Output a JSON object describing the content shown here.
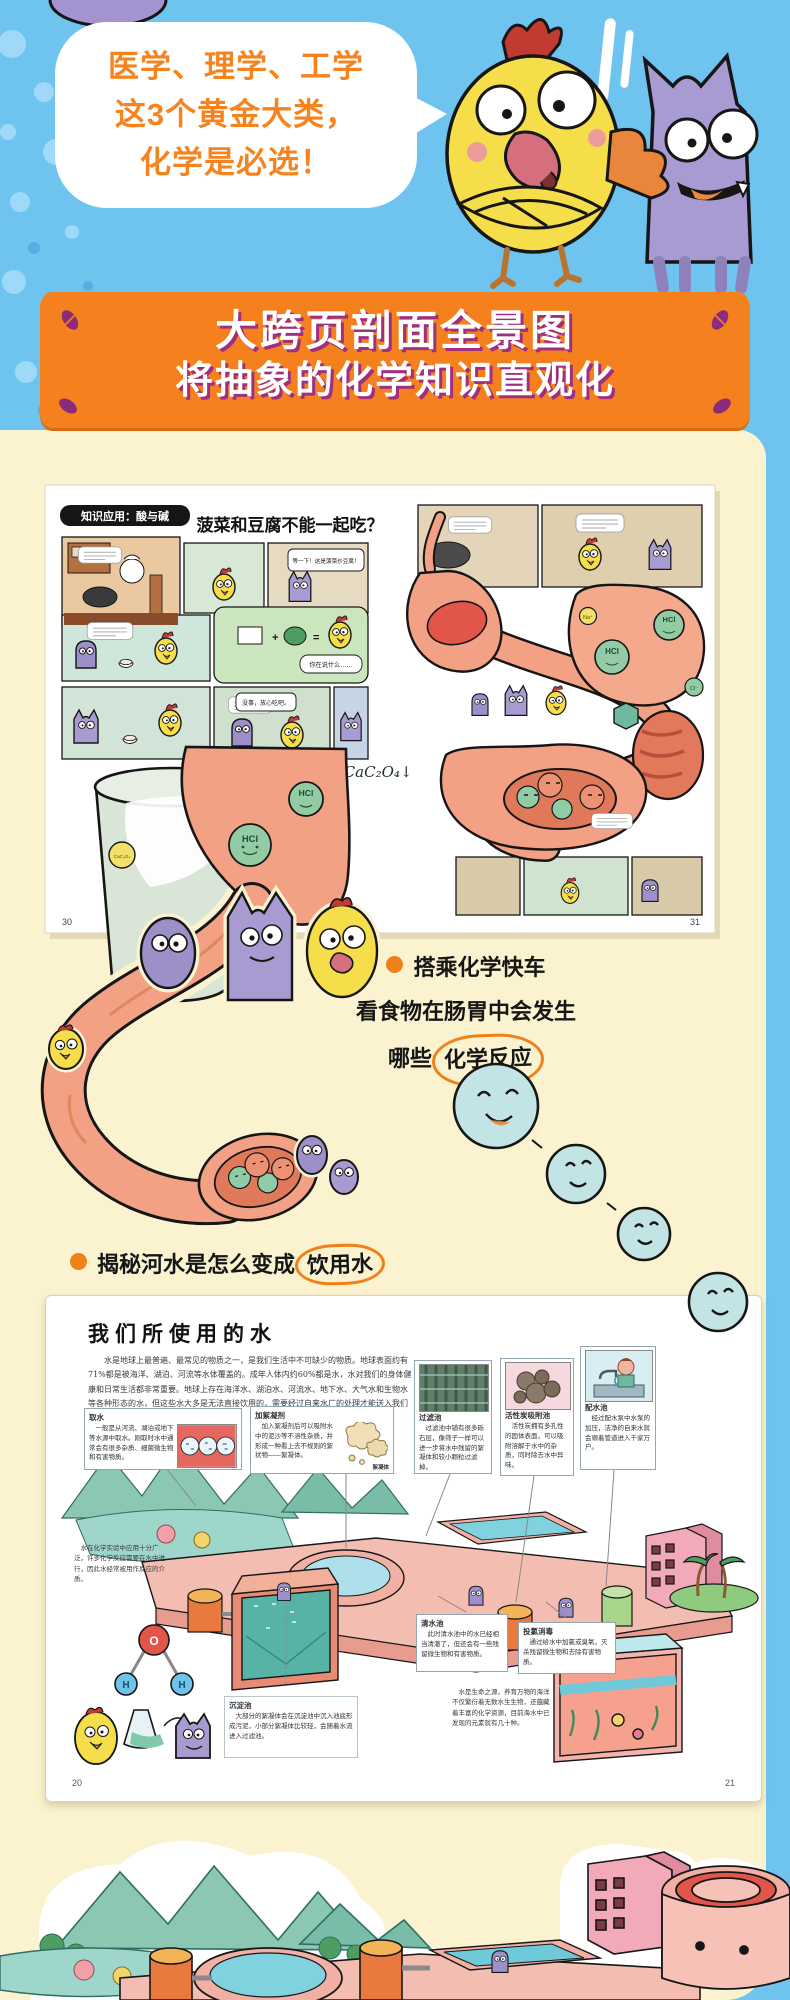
{
  "colors": {
    "sky_blue": "#6FC4EF",
    "cream": "#FBF2CF",
    "banner_orange": "#F5811E",
    "banner_shadow": "#A02F7F",
    "accent_orange": "#F08119",
    "flesh": "#F2A184",
    "hcl_green": "#93CBA4"
  },
  "hero": {
    "bubble_lines": [
      "医学、理学、工学",
      "这3个黄金大类，",
      "化学是必选！"
    ]
  },
  "banner": {
    "line1": "大跨页剖面全景图",
    "line2": "将抽象的化学知识直观化"
  },
  "spread1": {
    "tag": "知识应用：酸与碱",
    "title": "菠菜和豆腐不能一起吃？",
    "equation": "C₂O₄²⁻+Ca²⁺═CaC₂O₄↓",
    "labels": {
      "acid": "HCl",
      "sodium": "Na⁺",
      "chloride": "Cl⁻",
      "precipitate": "CaC₂O₄"
    },
    "bubbles": {
      "b1": "等一下！这是菠菜炒豆腐！",
      "b2": "你在说什么……",
      "b3": "没事，放心吃吧。"
    },
    "page_left": "30",
    "page_right": "31"
  },
  "caption": {
    "line1": "搭乘化学快车",
    "line2": "看食物在肠胃中会发生",
    "line3_prefix": "哪些",
    "line3_circled": "化学反应"
  },
  "bullet": {
    "prefix": "揭秘河水是怎么变成",
    "circled": "饮用水"
  },
  "spread2": {
    "title": "我们所使用的水",
    "intro": "水是地球上最普遍、最常见的物质之一，是我们生活中不可缺少的物质。地球表面约有71%都是被海洋、湖泊、河流等水体覆盖的。成年人体内约60%都是水，水对我们的身体健康和日常生活都非常重要。地球上存在海洋水、湖泊水、河流水、地下水、大气水和生物水等各种形态的水，但这些水大多是无法直接饮用的，需要经过自来水厂的处理才能送入我们的家庭。",
    "boxes": [
      {
        "title": "取水",
        "text": "一般是从河流、湖泊或地下等水源中取水。刚取时水中通常会有很多杂质、细菌微生物和有害物质。"
      },
      {
        "title": "加絮凝剂",
        "text": "加入絮凝剂后可以吸附水中的泥沙等不溶性杂质，并形成一种看上去不规则的絮状物——絮凝体。"
      },
      {
        "title": "过滤池",
        "text": "过滤池中铺有很多砾石层，像筛子一样可以进一步将水中残留的絮凝体和较小颗粒过滤掉。"
      },
      {
        "title": "活性炭吸附池",
        "text": "活性炭拥有多孔性的固体表面，可以吸附溶解于水中的杂质，同时除去水中异味。"
      },
      {
        "title": "配水池",
        "text": "经过配水泵中水泵的加压，洁净的自来水就会顺着管道进入千家万户。"
      },
      {
        "title": "清水池",
        "text": "此时清水池中的水已经相当清澈了，但还会有一些残留微生物和有害物质。"
      },
      {
        "title": "投氯消毒",
        "text": "通过给水中加氯或臭氧，灭杀残留微生物和去除有害物质。"
      },
      {
        "title": "沉淀池",
        "text": "大部分的絮凝体会在沉淀池中沉入池底形成污泥，小部分絮凝体比较轻，会随着水流进入过滤池。"
      }
    ],
    "floc_label": "絮凝体",
    "side_note": "水在化学实验中应用十分广泛，许多化学反应需要在水中进行，因此水经常被用作反应的介质。",
    "sea_note": "水是生命之源，养育万物的海洋不仅繁衍着无数水生生物，还蕴藏着丰富的化学资源，目前海水中已发现的元素就有几十种。",
    "molecule": {
      "o": "O",
      "h": "H"
    },
    "page_left": "20",
    "page_right": "21"
  }
}
